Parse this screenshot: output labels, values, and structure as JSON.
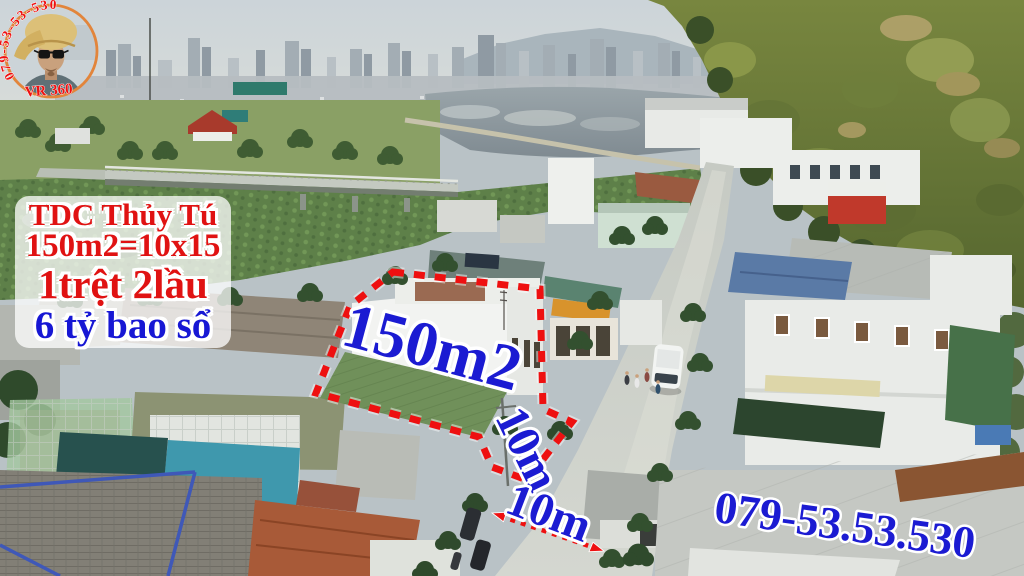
{
  "watermark": {
    "phone_curved": "079-53-53-530",
    "vr_label": "VR 360"
  },
  "info_panel": {
    "project_name": "TDC Thủy Tú",
    "area_line": "150m2=10x15",
    "floors_line": "1trệt 2lầu",
    "price_line": "6 tỷ bao sổ"
  },
  "annotations": {
    "area_label": "150m2",
    "frontage_label": "10m",
    "road_width_label": "10m",
    "phone_number": "079-53.53.530"
  },
  "colors": {
    "annotation_red": "#ee1010",
    "annotation_blue": "#1b1bd2",
    "panel_red": "#e01212",
    "panel_blue": "#1717d4",
    "outline_white": "#ffffff",
    "avatar_ring": "#e2853b"
  }
}
